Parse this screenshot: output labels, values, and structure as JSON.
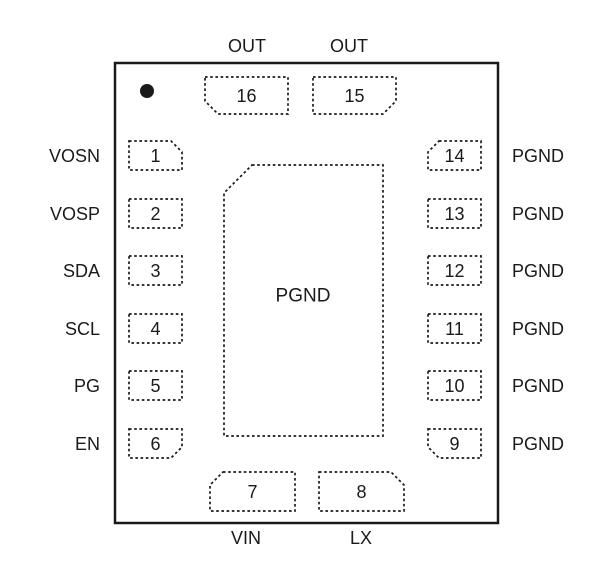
{
  "diagram": {
    "type": "ic-pinout",
    "package_pin_count": "16",
    "center_pad": {
      "label": "PGND"
    }
  },
  "pins": {
    "top": [
      {
        "number": "16",
        "label": "OUT"
      },
      {
        "number": "15",
        "label": "OUT"
      }
    ],
    "bottom": [
      {
        "number": "7",
        "label": "VIN"
      },
      {
        "number": "8",
        "label": "LX"
      }
    ],
    "left": [
      {
        "number": "1",
        "label": "VOSN"
      },
      {
        "number": "2",
        "label": "VOSP"
      },
      {
        "number": "3",
        "label": "SDA"
      },
      {
        "number": "4",
        "label": "SCL"
      },
      {
        "number": "5",
        "label": "PG"
      },
      {
        "number": "6",
        "label": "EN"
      }
    ],
    "right": [
      {
        "number": "14",
        "label": "PGND"
      },
      {
        "number": "13",
        "label": "PGND"
      },
      {
        "number": "12",
        "label": "PGND"
      },
      {
        "number": "11",
        "label": "PGND"
      },
      {
        "number": "10",
        "label": "PGND"
      },
      {
        "number": "9",
        "label": "PGND"
      }
    ]
  },
  "colors": {
    "line": "#1a1a1a",
    "background": "#ffffff",
    "text": "#1a1a1a"
  }
}
